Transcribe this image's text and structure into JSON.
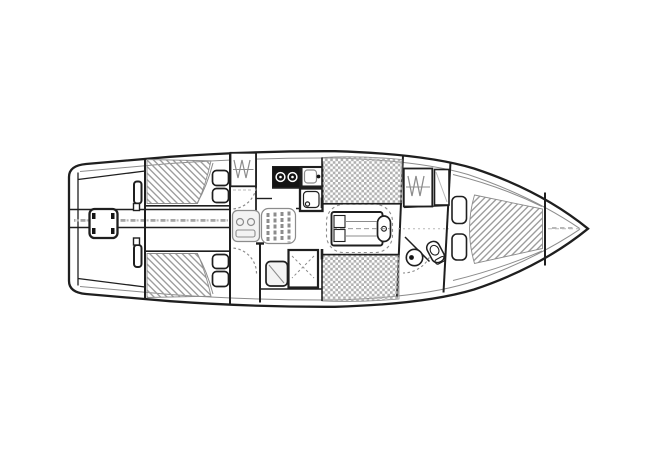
{
  "meta": {
    "type": "technical line drawing",
    "subject": "sailboat interior accommodation plan, overhead view, bow pointing right",
    "visible_text": ""
  },
  "colors": {
    "paper": "#ffffff",
    "ink": "#1f1f1f",
    "mid_gray": "#8c8c8c",
    "light_gray": "#b8b8b8",
    "hatch_gray": "#9d9d9d",
    "checker_gray": "#b0b0b0",
    "appliance_black": "#141414",
    "marks_gray": "#a6a6a6",
    "soft_fill": "#f3f3f3"
  },
  "components": {
    "hull": "hull outline with transom aft (left) and pointed bow (right)",
    "cockpit": [
      "center hatch",
      "cleat bars",
      "bench edges"
    ],
    "aft_cabins": [
      "port double berth (diagonal hatch) with two pillows",
      "starboard double berth (diagonal hatch) with two pillows"
    ],
    "machinery": [
      "engine box under companionway",
      "companionway steps",
      "door swing arcs"
    ],
    "galley": [
      "two-burner stove",
      "sink unit",
      "icebox unit",
      "hanging locker"
    ],
    "salon": [
      "port settee (checkered cushion)",
      "starboard settee (checkered cushion)",
      "drop-leaf table with dashed leaf outline"
    ],
    "nav_station": [
      "chart table",
      "navigator seat"
    ],
    "head": [
      "round wash basin",
      "marine toilet",
      "door swing"
    ],
    "forward": [
      "hanging locker with hanger zigzag",
      "small locker",
      "V-berth (diagonal hatch) with two pillows",
      "anchor locker"
    ]
  }
}
